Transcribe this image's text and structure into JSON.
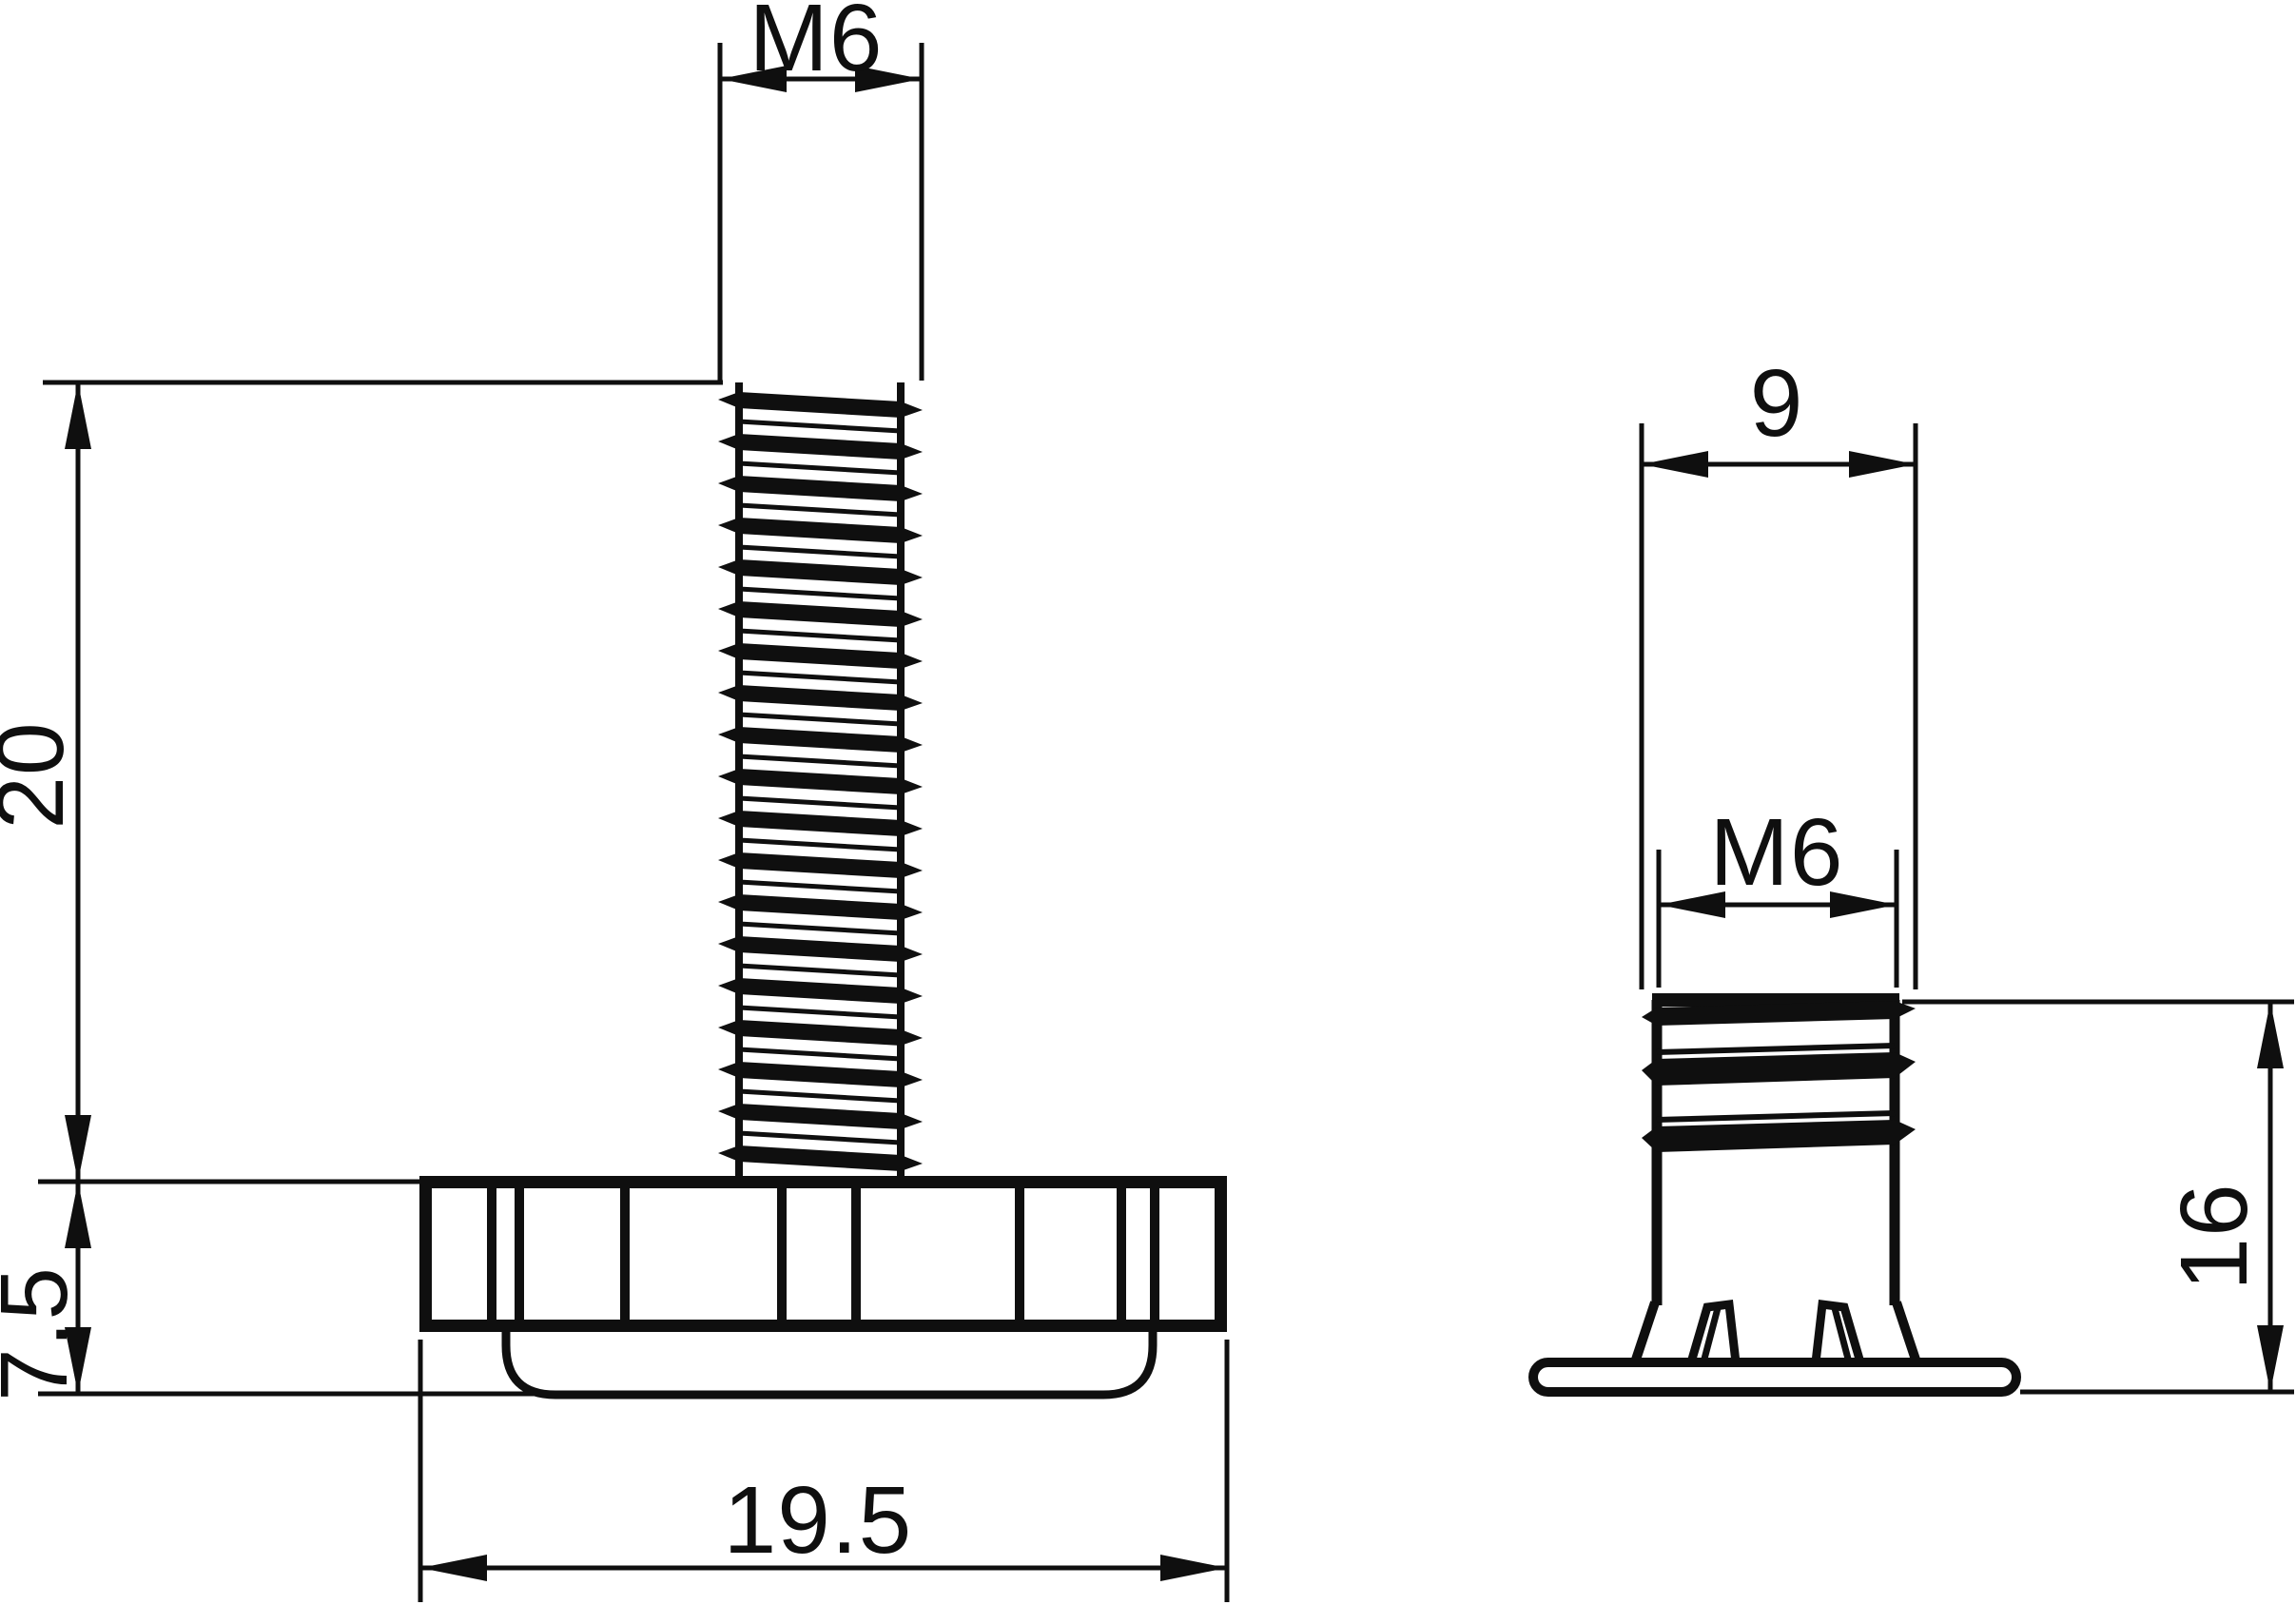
{
  "colors": {
    "background": "#ffffff",
    "ink": "#0f0f0f"
  },
  "stud_view": {
    "dim_thread": "M6",
    "dim_thread_length": "20",
    "dim_head_height": "7.5",
    "dim_head_width": "19.5"
  },
  "insert_view": {
    "dim_outer_width": "9",
    "dim_thread": "M6",
    "dim_height": "16"
  }
}
